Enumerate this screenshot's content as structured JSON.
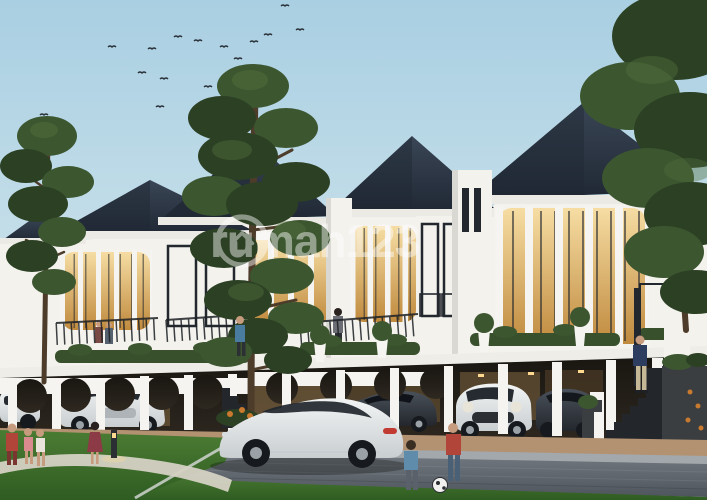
{
  "watermark": {
    "logo_icon": "rumah123-house-logo-icon",
    "text": "rumah123"
  },
  "colors": {
    "sky_top": "#a9cfe2",
    "sky_mid": "#c8e0ea",
    "sky_horizon": "#e3eff2",
    "roof_dark": "#1f2733",
    "roof_light": "#3a4656",
    "wall_white": "#f3f2ed",
    "wall_shade": "#d9d8d2",
    "fascia_white": "#eceae4",
    "window_glow_top": "#f6dda3",
    "window_glow_bottom": "#c08a3e",
    "frame_dark": "#23282e",
    "carport_dark": "#191611",
    "carport_warm": "#6b5638",
    "column_white": "#f5f4f0",
    "deck_white": "#eeede8",
    "hedge_green": "#39502c",
    "foliage_dark": "#2c4024",
    "foliage_mid": "#3c5630",
    "foliage_light": "#516f3c",
    "trunk_brown": "#4e3c2b",
    "apron_warm": "#b39272",
    "sidewalk_grey": "#a2a8ac",
    "street_light": "#757c83",
    "street_dark": "#4e555c",
    "lawn_light": "#4b7c33",
    "lawn_dark": "#2f5c22",
    "path_light": "#d5d2c4",
    "stair_dark": "#23262b",
    "stone_planter": "#3b3e41",
    "car_white": "#f2f4f4",
    "car_white_shade": "#c9ced1",
    "car_dark": "#363b42",
    "wheel_dark": "#16191d",
    "hub_grey": "#9aa2a8",
    "taillight_red": "#c23b33",
    "glow_warm": "#ffd98f",
    "bird_dark": "#2a3138",
    "skin": "#c79b7d",
    "red_jacket": "#b2453a",
    "blue_shirt": "#5f8cab",
    "navy_top": "#2d3d5f",
    "maroon_dress": "#8c3a45",
    "khaki_pants": "#c5b897",
    "jeans_blue": "#4a6077",
    "ball_white": "#f0f0ee",
    "orange_flower": "#c97a2f"
  }
}
